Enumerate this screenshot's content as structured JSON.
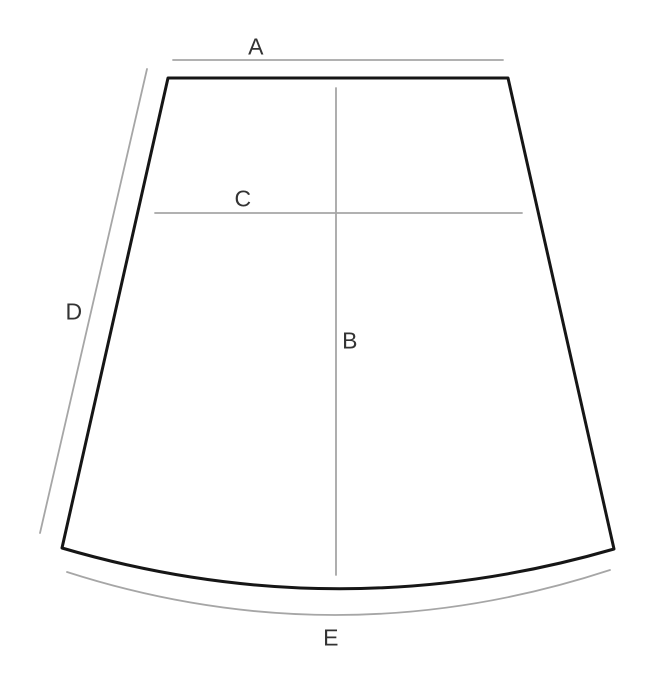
{
  "colors": {
    "background": "#ffffff",
    "outline": "#161616",
    "measure-line": "#a6a6a6",
    "label": "#333333"
  },
  "diagram": {
    "type": "skirt-measurement-diagram",
    "labels": [
      {
        "id": "A",
        "text": "A",
        "refers_to": "top-width-guide-line"
      },
      {
        "id": "B",
        "text": "B",
        "refers_to": "center-vertical-guide-line"
      },
      {
        "id": "C",
        "text": "C",
        "refers_to": "upper-horizontal-guide-line"
      },
      {
        "id": "D",
        "text": "D",
        "refers_to": "left-side-slant-guide-line"
      },
      {
        "id": "E",
        "text": "E",
        "refers_to": "bottom-hem-curve-guide-line"
      }
    ]
  }
}
